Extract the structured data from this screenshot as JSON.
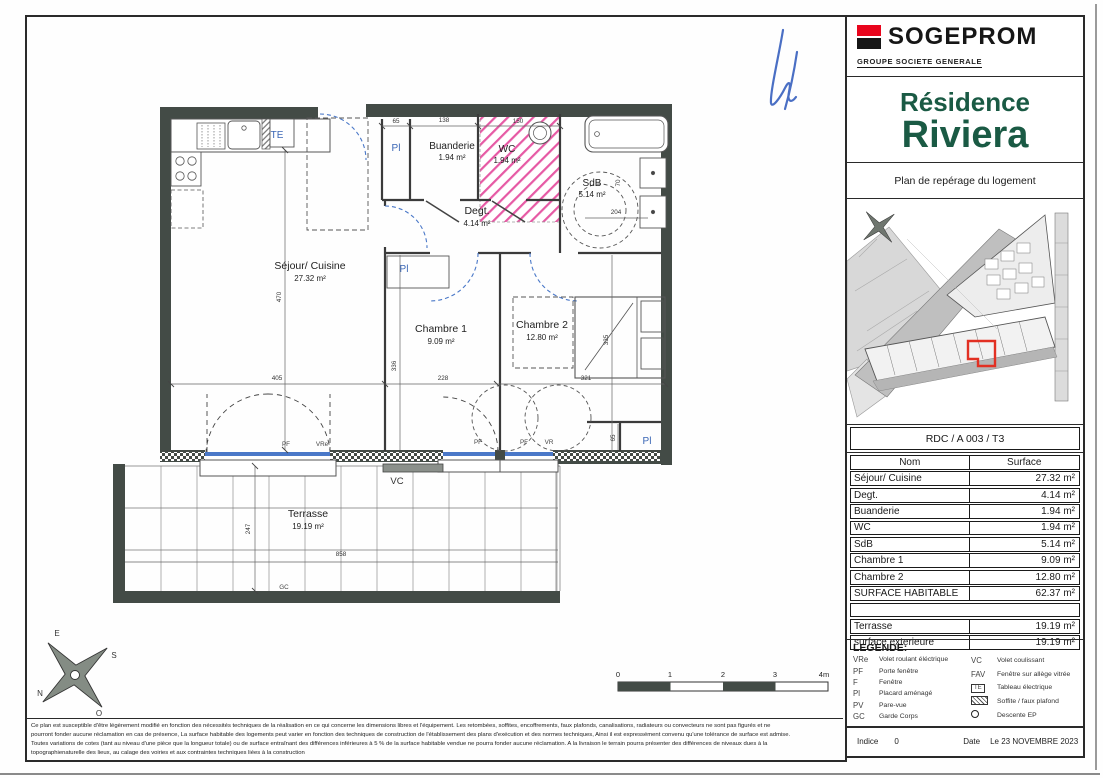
{
  "titleblock": {
    "brand": "SOGEPROM",
    "brand_sub": "GROUPE SOCIETE GENERALE",
    "residence_line1": "Résidence",
    "residence_line2": "Riviera",
    "plan_caption": "Plan de repérage du logement",
    "unit_id": "RDC / A 003 / T3",
    "colors": {
      "brand_red": "#e9051d",
      "brand_green": "#1a5a44",
      "highlight_red": "#e23023"
    }
  },
  "table": {
    "header": {
      "name": "Nom",
      "value": "Surface"
    },
    "rows": [
      {
        "name": "Séjour/ Cuisine",
        "value": "27.32 m²"
      },
      {
        "name": "Degt.",
        "value": "4.14 m²"
      },
      {
        "name": "Buanderie",
        "value": "1.94 m²"
      },
      {
        "name": "WC",
        "value": "1.94 m²"
      },
      {
        "name": "SdB",
        "value": "5.14 m²"
      },
      {
        "name": "Chambre 1",
        "value": "9.09 m²"
      },
      {
        "name": "Chambre 2",
        "value": "12.80 m²"
      },
      {
        "name": "SURFACE HABITABLE",
        "value": "62.37 m²"
      },
      {
        "name": "",
        "value": ""
      },
      {
        "name": "Terrasse",
        "value": "19.19 m²"
      },
      {
        "name": "surface exterieure",
        "value": "19.19 m²"
      }
    ]
  },
  "legend": {
    "title": "LEGENDE:",
    "left": [
      {
        "key": "VRe",
        "label": "Volet roulant éléctrique"
      },
      {
        "key": "PF",
        "label": "Porte fenêtre"
      },
      {
        "key": "F",
        "label": "Fenêtre"
      },
      {
        "key": "Pl",
        "label": "Placard aménagé"
      },
      {
        "key": "PV",
        "label": "Pare-vue"
      },
      {
        "key": "GC",
        "label": "Garde Corps"
      }
    ],
    "right": [
      {
        "key": "VC",
        "label": "Volet coulissant"
      },
      {
        "key": "FAV",
        "label": "Fenêtre sur allège vitrée"
      },
      {
        "key": "TE",
        "label": "Tableau électrique"
      },
      {
        "key": "",
        "label": "Soffite / faux plafond"
      },
      {
        "key": "",
        "label": "Descente EP"
      }
    ]
  },
  "footer": {
    "indice_label": "Indice",
    "indice_value": "0",
    "date_label": "Date",
    "date_value": "Le 23 NOVEMBRE 2023",
    "disclaimer": [
      "Ce plan est susceptible d'être légèrement modifié en fonction des nécessités techniques de la réalisation en ce qui concerne les dimensions libres et l'équipement. Les retombées, soffites, encoffrements, faux plafonds, canalisations, radiateurs ou convecteurs ne sont pas figurés et ne",
      "pourront fonder aucune réclamation en cas de présence, La surface habitable des logements peut varier en fonction des techniques de construction de l'établissement des plans d'exécution et des normes techniques, Ainsi il est expressément convenu qu'une tolérance de surface est admise.",
      "Toutes variations de cotes (tant au niveau d'une pièce que la longueur totale) ou de surface entraînant des différences inférieures à 5 % de la surface habitable vendue ne pourra fonder aucune réclamation. A la livraison le terrain pourra présenter des différences de niveaux dues à la",
      "topographienaturelle des lieux, au calage des voiries et aux contraintes techniques liées à la construction"
    ]
  },
  "plan": {
    "rooms": [
      {
        "name": "Séjour/ Cuisine",
        "area": "27.32 m²"
      },
      {
        "name": "Degt.",
        "area": "4.14 m²"
      },
      {
        "name": "Buanderie",
        "area": "1.94 m²"
      },
      {
        "name": "WC",
        "area": "1.94 m²"
      },
      {
        "name": "SdB",
        "area": "5.14 m²"
      },
      {
        "name": "Chambre 1",
        "area": "9.09 m²"
      },
      {
        "name": "Chambre 2",
        "area": "12.80 m²"
      },
      {
        "name": "Terrasse",
        "area": "19.19 m²"
      }
    ],
    "dims": {
      "d65a": "65",
      "d138": "138",
      "d150": "150",
      "d470": "470",
      "d405": "405",
      "d336": "336",
      "d228": "228",
      "d321": "321",
      "d335": "335",
      "d204": "204",
      "d70": "70",
      "d65b": "65",
      "d247": "247",
      "d858": "858"
    },
    "tags": {
      "te": "TE",
      "pl": "Pl",
      "pf": "PF",
      "vre": "VRe",
      "vr": "VR",
      "vc": "VC",
      "gc": "GC"
    },
    "scale": {
      "t0": "0",
      "t1": "1",
      "t2": "2",
      "t3": "3",
      "t4": "4m"
    },
    "compass": {
      "n": "N",
      "s": "S",
      "e": "E",
      "o": "O"
    }
  }
}
